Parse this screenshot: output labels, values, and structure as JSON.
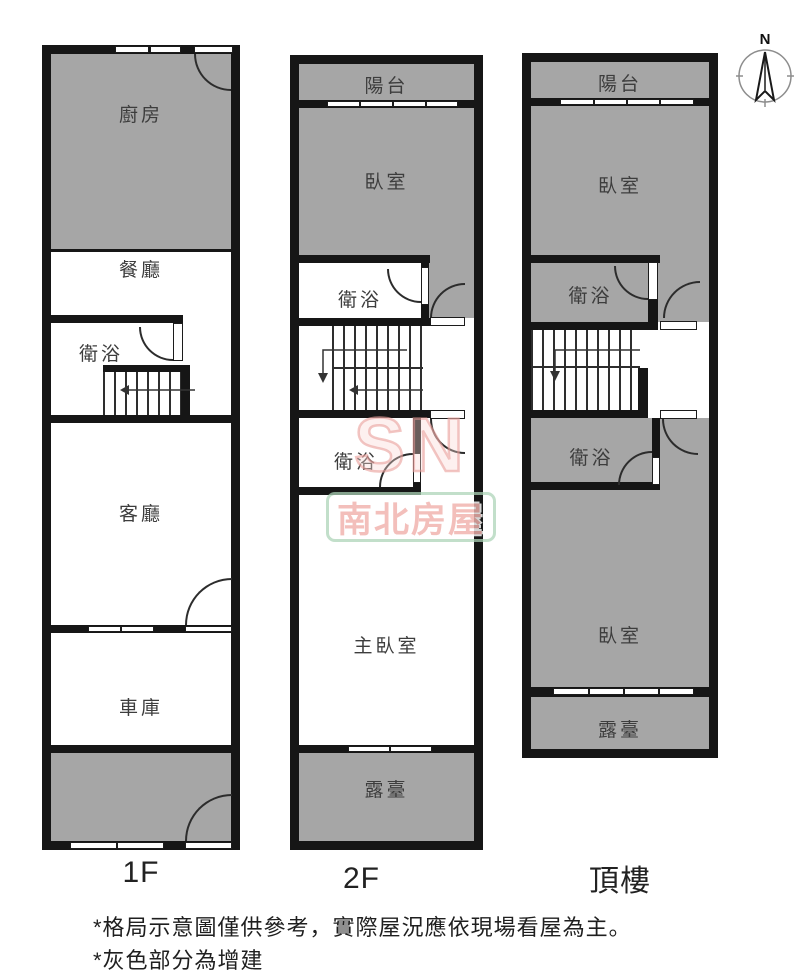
{
  "plans": {
    "f1": {
      "label": "1F",
      "rooms": {
        "kitchen": "廚房",
        "dining": "餐廳",
        "bath": "衛浴",
        "living": "客廳",
        "garage": "車庫"
      }
    },
    "f2": {
      "label": "2F",
      "rooms": {
        "balcony": "陽台",
        "bedroom": "臥室",
        "bath_upper": "衛浴",
        "bath_lower": "衛浴",
        "master": "主臥室",
        "terrace": "露臺"
      }
    },
    "top": {
      "label": "頂樓",
      "rooms": {
        "balcony": "陽台",
        "bedroom_front": "臥室",
        "bath_upper": "衛浴",
        "bath_lower": "衛浴",
        "bedroom_rear": "臥室",
        "terrace": "露臺"
      }
    }
  },
  "compass": {
    "north_label": "N"
  },
  "watermark": {
    "logo": "SN",
    "brand": "南北房屋"
  },
  "footnotes": {
    "line1": "*格局示意圖僅供參考，實際屋況應依現場看屋為主。",
    "line2": "*灰色部分為增建"
  },
  "colors": {
    "annex_gray": "#a6a6a6",
    "wall_black": "#161616",
    "watermark_pink": "#eea49f",
    "watermark_green": "#add4b8"
  }
}
